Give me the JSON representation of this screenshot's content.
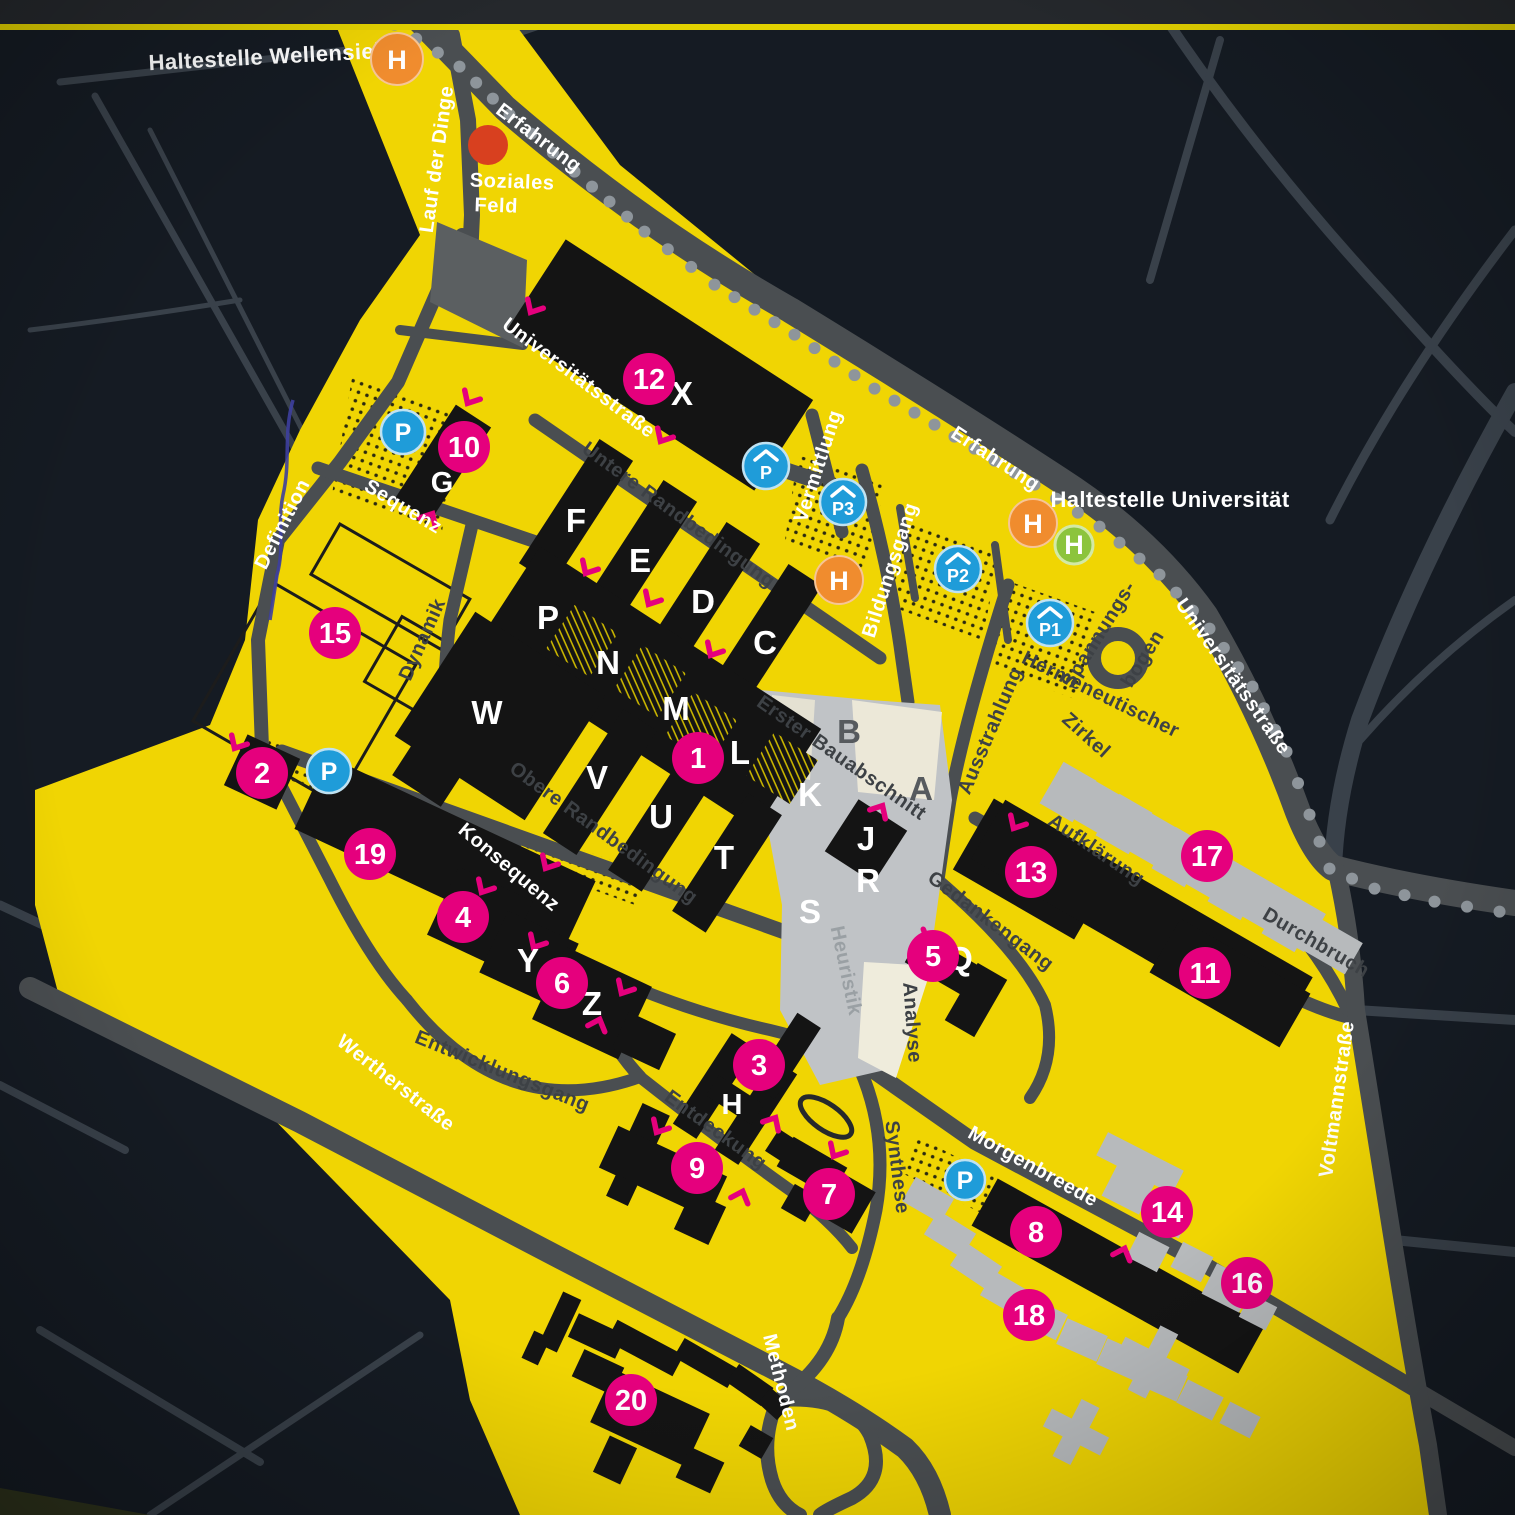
{
  "colors": {
    "campus_yellow": "#f0d503",
    "background": "#151b23",
    "road_gray": "#4a4e51",
    "building_black": "#141414",
    "building_gray": "#b7babc",
    "pedestrian_gray": "#c0c3c6",
    "accent_pink": "#e5007d",
    "parking_blue": "#1f9cd9",
    "bus_orange": "#f08c2e",
    "tram_green": "#8cc43c",
    "soziales_feld_red": "#d8401f"
  },
  "stops": {
    "wellensiek": "Haltestelle Wellensiek",
    "universitaet": "Haltestelle Universität"
  },
  "streets": {
    "lauf_der_dinge": "Lauf der Dinge",
    "erfahrung_nw": "Erfahrung",
    "erfahrung_ne": "Erfahrung",
    "universitaetsstrasse_w": "Universitätsstraße",
    "universitaetsstrasse_e": "Universitätsstraße",
    "untere_randbedingung": "Untere Randbedingung",
    "obere_randbedingung": "Obere Randbedingung",
    "vermittlung": "Vermittlung",
    "bildungsgang": "Bildungsgang",
    "sequenz": "Sequenz",
    "definition": "Definition",
    "dynamik": "Dynamik",
    "ausstrahlung": "Ausstrahlung",
    "spannungsbogen_1": "Spannungs-",
    "spannungsbogen_2": "bogen",
    "hermeneutischer": "Hermeneutischer",
    "zirkel": "Zirkel",
    "konsequenz": "Konsequenz",
    "aufklaerung": "Aufklärung",
    "durchbruch": "Durchbruch",
    "gedankengang": "Gedankengang",
    "analyse": "Analyse",
    "heuristik": "Heuristik",
    "synthese": "Synthese",
    "entwicklungsgang": "Entwicklungsgang",
    "entdeckung": "Entdeckung",
    "wertherstrasse": "Wertherstraße",
    "morgenbreede": "Morgenbreede",
    "voltmannstrasse": "Voltmannstraße",
    "methoden": "Methoden"
  },
  "areas": {
    "erster_bauabschnitt": "Erster Bauabschnitt",
    "soziales_feld_line1": "Soziales",
    "soziales_feld_line2": "Feld"
  },
  "markers": {
    "m1": "1",
    "m2": "2",
    "m3": "3",
    "m4": "4",
    "m5": "5",
    "m6": "6",
    "m7": "7",
    "m8": "8",
    "m9": "9",
    "m10": "10",
    "m11": "11",
    "m12": "12",
    "m13": "13",
    "m14": "14",
    "m15": "15",
    "m16": "16",
    "m17": "17",
    "m18": "18",
    "m19": "19",
    "m20": "20"
  },
  "building_letters": {
    "a": "A",
    "b": "B",
    "c": "C",
    "d": "D",
    "e": "E",
    "f": "F",
    "g": "G",
    "h": "H",
    "j": "J",
    "k": "K",
    "l": "L",
    "m": "M",
    "n": "N",
    "p": "P",
    "q": "Q",
    "r": "R",
    "s": "S",
    "t": "T",
    "u": "U",
    "v": "V",
    "w": "W",
    "x": "X",
    "y": "Y",
    "z": "Z"
  },
  "parking": {
    "p": "P",
    "p1": "P1",
    "p2": "P2",
    "p3": "P3"
  },
  "transit": {
    "bus": "H",
    "tram": "H"
  }
}
